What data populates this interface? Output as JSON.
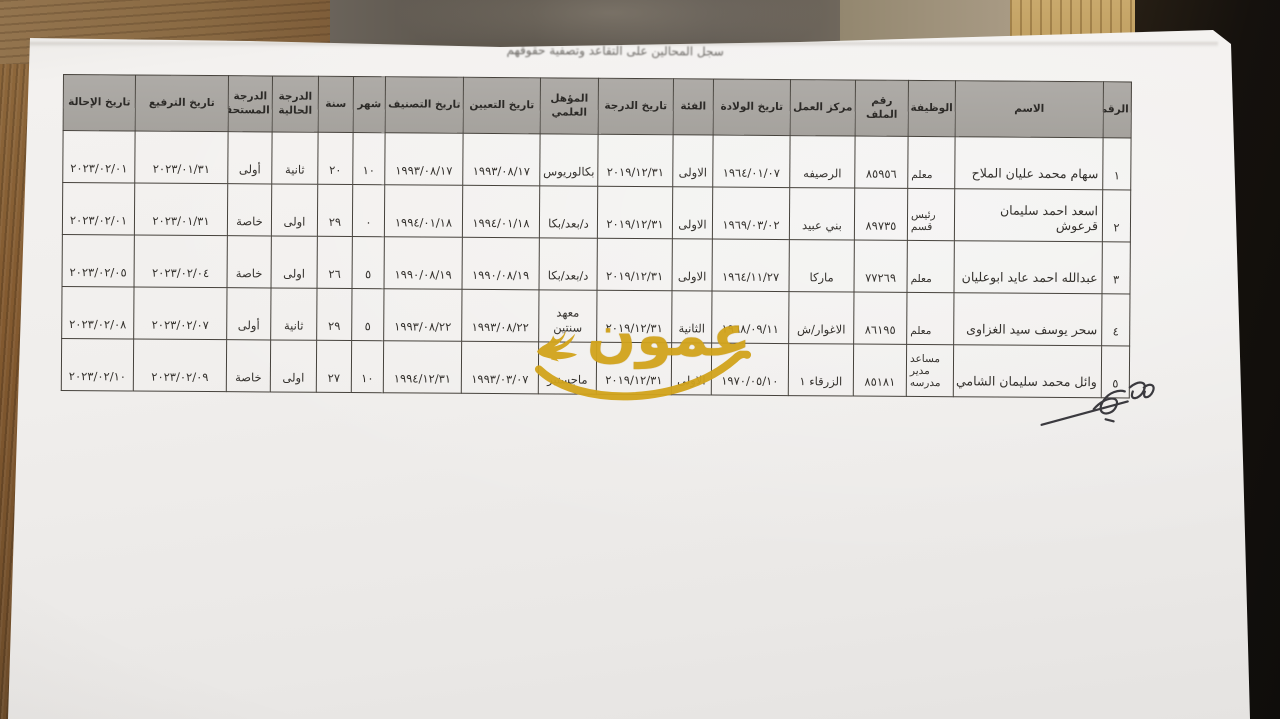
{
  "document": {
    "title": "سجل المحالين على التقاعد وتصفية حقوقهم"
  },
  "watermark": {
    "text": "عمون",
    "color": "#d2a41c",
    "icon": "bird-icon"
  },
  "table": {
    "headers": [
      "الرقم",
      "الاسم",
      "الوظيفة",
      "رقم الملف",
      "مركز العمل",
      "تاريخ الولادة",
      "الفئة",
      "تاريخ الدرجة",
      "المؤهل العلمي",
      "تاريخ التعيين",
      "تاريخ التصنيف",
      "شهر",
      "سنة",
      "الدرجة الحالية",
      "الدرجة المستحقة",
      "تاريخ الترفيع",
      "تاريخ الإحالة"
    ],
    "rows": [
      [
        "١",
        "سهام محمد عليان الملاح",
        "معلم",
        "٨٥٩٥٦",
        "الرصيفه",
        "١٩٦٤/٠١/٠٧",
        "الاولى",
        "٢٠١٩/١٢/٣١",
        "بكالوريوس",
        "١٩٩٣/٠٨/١٧",
        "١٩٩٣/٠٨/١٧",
        "١٠",
        "٢٠",
        "ثانية",
        "أولى",
        "٢٠٢٣/٠١/٣١",
        "٢٠٢٣/٠٢/٠١"
      ],
      [
        "٢",
        "اسعد احمد سليمان قرعوش",
        "رئيس قسم",
        "٨٩٧٣٥",
        "بني عبيد",
        "١٩٦٩/٠٣/٠٢",
        "الاولى",
        "٢٠١٩/١٢/٣١",
        "د/بعد/بكا",
        "١٩٩٤/٠١/١٨",
        "١٩٩٤/٠١/١٨",
        "٠",
        "٢٩",
        "اولى",
        "خاصة",
        "٢٠٢٣/٠١/٣١",
        "٢٠٢٣/٠٢/٠١"
      ],
      [
        "٣",
        "عبدالله احمد عايد ابوعليان",
        "معلم",
        "٧٧٢٦٩",
        "ماركا",
        "١٩٦٤/١١/٢٧",
        "الاولى",
        "٢٠١٩/١٢/٣١",
        "د/بعد/بكا",
        "١٩٩٠/٠٨/١٩",
        "١٩٩٠/٠٨/١٩",
        "٥",
        "٢٦",
        "اولى",
        "خاصة",
        "٢٠٢٣/٠٢/٠٤",
        "٢٠٢٣/٠٢/٠٥"
      ],
      [
        "٤",
        "سحر يوسف سيد الغزاوى",
        "معلم",
        "٨٦١٩٥",
        "الاغوار/ش",
        "١٩٦٨/٠٩/١١",
        "الثانية",
        "٢٠١٩/١٢/٣١",
        "معهد سنتين",
        "١٩٩٣/٠٨/٢٢",
        "١٩٩٣/٠٨/٢٢",
        "٥",
        "٢٩",
        "ثانية",
        "أولى",
        "٢٠٢٣/٠٢/٠٧",
        "٢٠٢٣/٠٢/٠٨"
      ],
      [
        "٥",
        "وائل محمد سليمان الشامي",
        "مساعد مدير مدرسه",
        "٨٥١٨١",
        "الزرقاء ١",
        "١٩٧٠/٠٥/١٠",
        "الاولى",
        "٢٠١٩/١٢/٣١",
        "ماجستير",
        "١٩٩٣/٠٣/٠٧",
        "١٩٩٤/١٢/٣١",
        "١٠",
        "٢٧",
        "اولى",
        "خاصة",
        "٢٠٢٣/٠٢/٠٩",
        "٢٠٢٣/٠٢/١٠"
      ]
    ]
  },
  "colors": {
    "header_fill": "#a9a6a2",
    "table_border": "#46423c",
    "paper": "#efedea",
    "watermark_gold": "#d2a41c",
    "desk_wood": "#8a6138",
    "desk_dark": "#15110d"
  }
}
